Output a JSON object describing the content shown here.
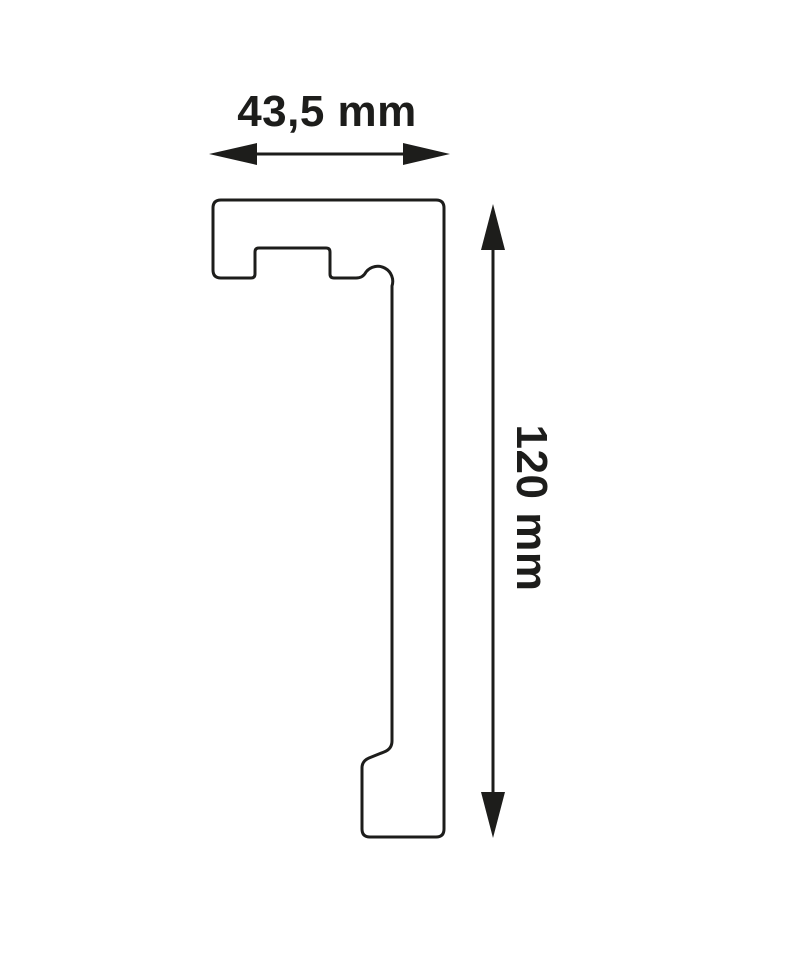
{
  "diagram": {
    "kind": "profile-cross-section-drawing",
    "width_dimension": {
      "label": "43,5 mm"
    },
    "height_dimension": {
      "label": "120 mm"
    },
    "colors": {
      "line": "#1d1d1b",
      "background": "#ffffff"
    }
  }
}
